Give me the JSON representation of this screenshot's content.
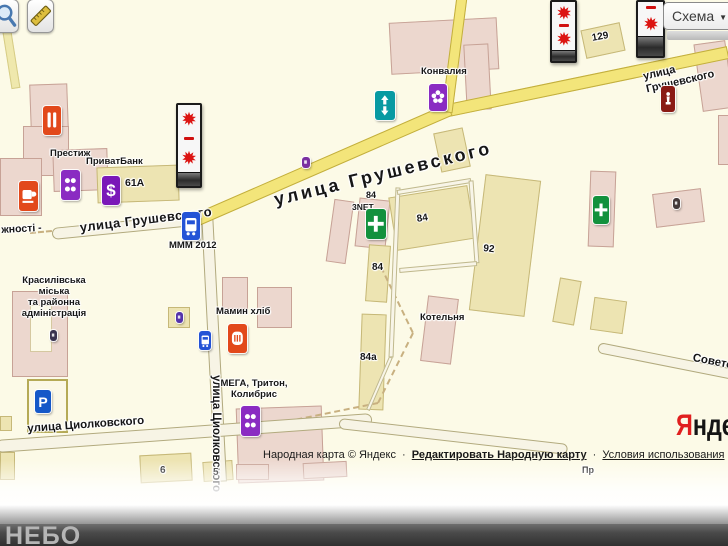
{
  "controls": {
    "map_type_button": {
      "label": "Схема",
      "caret": "▼"
    },
    "zoom_tool": "magnifier",
    "measure_tool": "ruler"
  },
  "footer": {
    "watermark": "НЕБО"
  },
  "attribution": {
    "text": "Народная карта © Яндекс",
    "separator": "·",
    "edit_link": "Редактировать Народную карту",
    "terms_link": "Условия использования"
  },
  "logo": {
    "first_letter": "Я",
    "rest": "ндекс",
    "brand_red": "#e01f1f"
  },
  "map": {
    "background": "#fcfae7",
    "road_yellow": "#f3e57a",
    "building_pink": "#ecd7ce",
    "building_tan": "#ede4b2",
    "roads": [
      {
        "name": "road-edge-left",
        "kind": "ypale",
        "x1": 2,
        "y1": 0,
        "x2": 16,
        "y2": 88,
        "w": 9
      },
      {
        "name": "road-tsiolkovsky-vertical",
        "kind": "white",
        "x1": 207,
        "y1": 212,
        "x2": 221,
        "y2": 482,
        "w": 12
      },
      {
        "name": "road-hrushevsky-west",
        "kind": "white",
        "x1": 52,
        "y1": 234,
        "x2": 204,
        "y2": 219,
        "w": 12,
        "round": true
      },
      {
        "name": "road-tsiolkovsky",
        "kind": "white",
        "x1": -4,
        "y1": 446,
        "x2": 372,
        "y2": 419,
        "w": 13,
        "round": true
      },
      {
        "name": "road-south",
        "kind": "white",
        "x1": 339,
        "y1": 423,
        "x2": 568,
        "y2": 449,
        "w": 11,
        "round": true
      },
      {
        "name": "road-sovetskaya",
        "kind": "white",
        "x1": 598,
        "y1": 347,
        "x2": 734,
        "y2": 374,
        "w": 11,
        "round": true
      },
      {
        "name": "lane-alley",
        "kind": "lane",
        "x1": 398,
        "y1": 187,
        "x2": 391,
        "y2": 357,
        "w": 5
      },
      {
        "name": "lane-alley-2",
        "kind": "lane",
        "x1": 391,
        "y1": 357,
        "x2": 368,
        "y2": 410,
        "w": 4
      },
      {
        "name": "lane-block-top",
        "kind": "lane",
        "x1": 397,
        "y1": 192,
        "x2": 471,
        "y2": 180,
        "w": 5
      },
      {
        "name": "lane-block-right",
        "kind": "lane",
        "x1": 471,
        "y1": 180,
        "x2": 477,
        "y2": 263,
        "w": 5
      },
      {
        "name": "lane-block-bottom",
        "kind": "lane",
        "x1": 477,
        "y1": 263,
        "x2": 399,
        "y2": 270,
        "w": 5
      },
      {
        "name": "road-hrushevsky-upper",
        "kind": "yellow",
        "x1": 728,
        "y1": 52,
        "x2": 448,
        "y2": 110,
        "w": 13
      },
      {
        "name": "road-hrushevsky-lower",
        "kind": "yellow",
        "x1": 450,
        "y1": 109,
        "x2": 193,
        "y2": 221,
        "w": 13
      },
      {
        "name": "road-branch-north",
        "kind": "yellow",
        "x1": 447,
        "y1": 112,
        "x2": 462,
        "y2": -4,
        "w": 11
      },
      {
        "name": "path-dashed-1",
        "kind": "dash",
        "x1": 381,
        "y1": 267,
        "x2": 413,
        "y2": 333,
        "w": 2
      },
      {
        "name": "path-dashed-2",
        "kind": "dash",
        "x1": 413,
        "y1": 333,
        "x2": 378,
        "y2": 403,
        "w": 2
      },
      {
        "name": "path-dashed-3",
        "kind": "dash",
        "x1": 378,
        "y1": 403,
        "x2": 230,
        "y2": 433,
        "w": 2
      },
      {
        "name": "path-dashed-west",
        "kind": "dash",
        "x1": 30,
        "y1": 233,
        "x2": 52,
        "y2": 231,
        "w": 2
      }
    ],
    "buildings": [
      {
        "x": 30,
        "y": 84,
        "w": 38,
        "h": 46,
        "r": -2,
        "k": "p"
      },
      {
        "x": 23,
        "y": 126,
        "w": 46,
        "h": 50,
        "r": 0,
        "k": "p"
      },
      {
        "x": 0,
        "y": 158,
        "w": 42,
        "h": 58,
        "r": 0,
        "k": "p"
      },
      {
        "x": 53,
        "y": 149,
        "w": 55,
        "h": 42,
        "r": -2,
        "k": "p"
      },
      {
        "x": 97,
        "y": 166,
        "w": 82,
        "h": 36,
        "r": -2,
        "k": "t"
      },
      {
        "x": 390,
        "y": 20,
        "w": 108,
        "h": 52,
        "r": -3,
        "k": "p"
      },
      {
        "x": 465,
        "y": 44,
        "w": 25,
        "h": 66,
        "r": -3,
        "k": "p"
      },
      {
        "x": 583,
        "y": 26,
        "w": 40,
        "h": 29,
        "r": -12,
        "k": "t"
      },
      {
        "x": 698,
        "y": 42,
        "w": 32,
        "h": 68,
        "r": -8,
        "k": "p"
      },
      {
        "x": 718,
        "y": 115,
        "w": 14,
        "h": 50,
        "r": 0,
        "k": "p"
      },
      {
        "x": 437,
        "y": 130,
        "w": 30,
        "h": 40,
        "r": -12,
        "k": "t"
      },
      {
        "x": 330,
        "y": 200,
        "w": 20,
        "h": 63,
        "r": 8,
        "k": "p"
      },
      {
        "x": 357,
        "y": 199,
        "w": 31,
        "h": 49,
        "r": 6,
        "k": "p"
      },
      {
        "x": 392,
        "y": 191,
        "w": 80,
        "h": 54,
        "r": -9,
        "k": "t"
      },
      {
        "x": 367,
        "y": 245,
        "w": 22,
        "h": 57,
        "r": 4,
        "k": "t"
      },
      {
        "x": 360,
        "y": 314,
        "w": 25,
        "h": 96,
        "r": 2,
        "k": "t"
      },
      {
        "x": 424,
        "y": 297,
        "w": 31,
        "h": 66,
        "r": 7,
        "k": "p"
      },
      {
        "x": 477,
        "y": 177,
        "w": 56,
        "h": 137,
        "r": 7,
        "k": "t"
      },
      {
        "x": 589,
        "y": 171,
        "w": 26,
        "h": 76,
        "r": 2,
        "k": "p"
      },
      {
        "x": 654,
        "y": 191,
        "w": 49,
        "h": 34,
        "r": -7,
        "k": "p"
      },
      {
        "x": 556,
        "y": 279,
        "w": 22,
        "h": 45,
        "r": 10,
        "k": "t"
      },
      {
        "x": 592,
        "y": 299,
        "w": 33,
        "h": 33,
        "r": 8,
        "k": "t"
      },
      {
        "x": 12,
        "y": 291,
        "w": 56,
        "h": 86,
        "r": 0,
        "k": "p"
      },
      {
        "x": 30,
        "y": 305,
        "w": 22,
        "h": 47,
        "r": 0,
        "k": "c"
      },
      {
        "x": 168,
        "y": 307,
        "w": 22,
        "h": 21,
        "r": 0,
        "k": "t"
      },
      {
        "x": 222,
        "y": 277,
        "w": 26,
        "h": 32,
        "r": 0,
        "k": "p"
      },
      {
        "x": 257,
        "y": 287,
        "w": 35,
        "h": 41,
        "r": 0,
        "k": "p"
      },
      {
        "x": 237,
        "y": 407,
        "w": 86,
        "h": 75,
        "r": -2,
        "k": "p"
      },
      {
        "name": "parking-lot",
        "x": 27,
        "y": 379,
        "w": 41,
        "h": 54,
        "r": 0,
        "k": "lot"
      },
      {
        "x": 140,
        "y": 454,
        "w": 52,
        "h": 28,
        "r": -3,
        "k": "t"
      },
      {
        "x": 0,
        "y": 452,
        "w": 15,
        "h": 28,
        "r": 0,
        "k": "t"
      },
      {
        "x": 0,
        "y": 416,
        "w": 12,
        "h": 15,
        "r": 0,
        "k": "t"
      },
      {
        "x": 203,
        "y": 461,
        "w": 30,
        "h": 20,
        "r": -4,
        "k": "t"
      },
      {
        "x": 236,
        "y": 464,
        "w": 33,
        "h": 16,
        "r": 0,
        "k": "p"
      },
      {
        "x": 303,
        "y": 462,
        "w": 44,
        "h": 16,
        "r": -3,
        "k": "p"
      }
    ],
    "billboards": [
      {
        "name": "billboard-1",
        "x": 176,
        "y": 103,
        "w": 26,
        "h": 85,
        "base": 13,
        "layout": "two"
      },
      {
        "name": "billboard-2",
        "x": 550,
        "y": 0,
        "w": 27,
        "h": 63,
        "base": 10,
        "layout": "two"
      },
      {
        "name": "billboard-3",
        "x": 636,
        "y": 0,
        "w": 29,
        "h": 58,
        "base": 19,
        "layout": "one"
      }
    ],
    "pois": [
      {
        "name": "restaurant-icon",
        "g": "bars",
        "x": 43,
        "y": 106,
        "w": 18,
        "h": 29,
        "bg": "#e2491b"
      },
      {
        "name": "cafe-icon",
        "g": "cup",
        "x": 19,
        "y": 181,
        "w": 19,
        "h": 30,
        "bg": "#e2491b"
      },
      {
        "name": "prestige-shop-icon",
        "g": "dots",
        "x": 61,
        "y": 170,
        "w": 19,
        "h": 30,
        "bg": "#8a2bc2"
      },
      {
        "name": "privatbank-icon",
        "g": "char",
        "ch": "$",
        "x": 102,
        "y": 176,
        "w": 18,
        "h": 29,
        "bg": "#7a18b8"
      },
      {
        "name": "bus-stop-mmm-icon",
        "g": "bus",
        "x": 182,
        "y": 212,
        "w": 18,
        "h": 28,
        "bg": "#2453d6"
      },
      {
        "name": "crossing-icon",
        "g": "arrows",
        "x": 375,
        "y": 91,
        "w": 20,
        "h": 29,
        "bg": "#089aa2"
      },
      {
        "name": "flower-shop-icon",
        "g": "flower",
        "x": 429,
        "y": 84,
        "w": 18,
        "h": 27,
        "bg": "#8a2bc2"
      },
      {
        "name": "purple-dot-marker",
        "g": "blank",
        "x": 302,
        "y": 157,
        "w": 8,
        "h": 11,
        "bg": "#7a2fa0"
      },
      {
        "name": "monument-icon",
        "g": "statue",
        "x": 661,
        "y": 86,
        "w": 14,
        "h": 26,
        "bg": "#8a1a14"
      },
      {
        "name": "pharmacy-3net-icon",
        "g": "cross",
        "x": 366,
        "y": 209,
        "w": 20,
        "h": 30,
        "bg": "#12913d"
      },
      {
        "name": "pharmacy-icon",
        "g": "cross",
        "x": 593,
        "y": 196,
        "w": 16,
        "h": 28,
        "bg": "#12913d"
      },
      {
        "name": "small-marker-icon",
        "g": "blank",
        "x": 673,
        "y": 198,
        "w": 7,
        "h": 11,
        "bg": "#453a3a"
      },
      {
        "name": "bakery-icon",
        "g": "bread",
        "x": 228,
        "y": 324,
        "w": 19,
        "h": 29,
        "bg": "#e2491b"
      },
      {
        "name": "bus-stop-icon",
        "g": "bus",
        "x": 199,
        "y": 331,
        "w": 12,
        "h": 19,
        "bg": "#2453d6"
      },
      {
        "name": "mega-shop-icon",
        "g": "dots",
        "x": 241,
        "y": 406,
        "w": 19,
        "h": 30,
        "bg": "#8a2bc2"
      },
      {
        "name": "parking-icon",
        "g": "char",
        "ch": "P",
        "x": 35,
        "y": 390,
        "w": 16,
        "h": 23,
        "bg": "#1558c8"
      },
      {
        "name": "admin-marker-icon",
        "g": "blank",
        "x": 50,
        "y": 330,
        "w": 7,
        "h": 11,
        "bg": "#3a3350"
      },
      {
        "name": "small-marker-2-icon",
        "g": "blank",
        "x": 176,
        "y": 312,
        "w": 7,
        "h": 11,
        "bg": "#5533aa"
      }
    ],
    "labels": [
      {
        "k": "street",
        "t": "улица Грушевского",
        "x": 79,
        "y": 221,
        "rot": -7,
        "fs": 13,
        "ls": 0.5
      },
      {
        "k": "street",
        "t": "улица Грушевского",
        "x": 272,
        "y": 190,
        "rot": -13.5,
        "fs": 18,
        "ls": 3
      },
      {
        "k": "street",
        "t": "улица Грушевского",
        "x": 642,
        "y": 71,
        "rot": -13,
        "fs": 11
      },
      {
        "k": "street",
        "t": "жності -",
        "x": 1,
        "y": 224,
        "rot": -3,
        "fs": 10.5
      },
      {
        "k": "street",
        "t": "улица Циолковского",
        "x": 27,
        "y": 423,
        "rot": -4,
        "fs": 11.5
      },
      {
        "k": "street",
        "t": "улица Циолковского",
        "x": 222,
        "y": 375,
        "rot": 90,
        "fs": 11.5
      },
      {
        "k": "street",
        "t": "Советская",
        "x": 694,
        "y": 352,
        "rot": 11,
        "fs": 11.5
      },
      {
        "k": "poi",
        "t": "Престиж",
        "x": 50,
        "y": 149
      },
      {
        "k": "poi",
        "t": "ПриватБанк",
        "x": 86,
        "y": 157
      },
      {
        "k": "poi",
        "t": "Конвалия",
        "x": 421,
        "y": 67
      },
      {
        "k": "poi",
        "t": "МММ 2012",
        "x": 169,
        "y": 241
      },
      {
        "k": "poi",
        "t": "3NET",
        "x": 352,
        "y": 203,
        "fs": 8.5
      },
      {
        "k": "poi",
        "t": "Мамин хліб",
        "x": 216,
        "y": 307
      },
      {
        "k": "poi",
        "t": "МЕГА, Тритон,\nКолибрис",
        "x": 217,
        "y": 379,
        "w": 74,
        "ctr": true
      },
      {
        "k": "poi",
        "t": "Котельня",
        "x": 420,
        "y": 313
      },
      {
        "k": "poi",
        "t": "Красилівська\nміська\nта районна\nадміністрація",
        "x": 14,
        "y": 276,
        "w": 80,
        "ctr": true
      },
      {
        "k": "poi",
        "t": "Пр",
        "x": 582,
        "y": 465,
        "fs": 9
      },
      {
        "k": "num",
        "t": "61А",
        "x": 125,
        "y": 177,
        "fs": 10.5
      },
      {
        "k": "num",
        "t": "129",
        "x": 591,
        "y": 33,
        "rot": -10
      },
      {
        "k": "num",
        "t": "84",
        "x": 366,
        "y": 190,
        "fs": 9
      },
      {
        "k": "num",
        "t": "84",
        "x": 416,
        "y": 214,
        "rot": -9
      },
      {
        "k": "num",
        "t": "84",
        "x": 372,
        "y": 262
      },
      {
        "k": "num",
        "t": "84а",
        "x": 360,
        "y": 352
      },
      {
        "k": "num",
        "t": "92",
        "x": 484,
        "y": 243,
        "rot": 7
      },
      {
        "k": "num",
        "t": "6",
        "x": 160,
        "y": 465
      },
      {
        "k": "num",
        "t": "5",
        "x": 213,
        "y": 467
      }
    ]
  }
}
